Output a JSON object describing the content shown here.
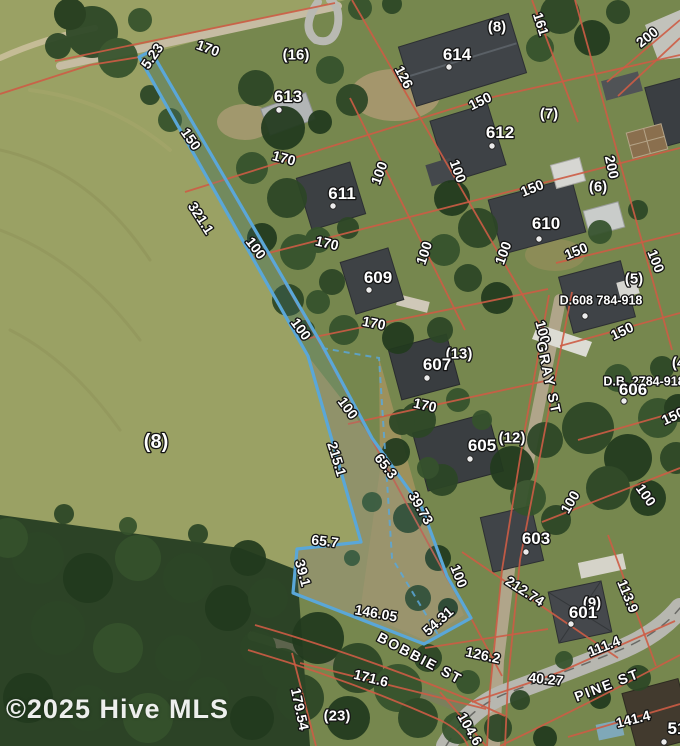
{
  "watermark": "©2025 Hive MLS",
  "colors": {
    "boundary": "#5aa7d8",
    "parcel_lines": "#cd5c45",
    "label_fill": "#ffffff",
    "label_halo": "#141414"
  },
  "map": {
    "type": "aerial-plat-map",
    "streets": [
      "GRAY ST",
      "BOBBIE ST",
      "PINE ST"
    ],
    "parcel_numbers": [
      "601",
      "603",
      "605",
      "606",
      "607",
      "609",
      "610",
      "611",
      "612",
      "613",
      "614"
    ],
    "deed_references": [
      "D.608 784-918",
      "D.B. 2784-918"
    ],
    "subject_boundary_points": "139,57 151,51 322,345 372,438 422,508 447,576 471,618 424,644 293,593 297,549 361,542 308,356",
    "interior_dashed_points": "322,348 379,358 392,558 440,638",
    "house_dots": [
      [
        279,
        110
      ],
      [
        449,
        67
      ],
      [
        492,
        146
      ],
      [
        333,
        206
      ],
      [
        539,
        239
      ],
      [
        369,
        290
      ],
      [
        427,
        378
      ],
      [
        470,
        459
      ],
      [
        526,
        552
      ],
      [
        571,
        624
      ],
      [
        624,
        401
      ],
      [
        585,
        316
      ],
      [
        664,
        742
      ]
    ],
    "labels": [
      {
        "t": "5.23",
        "x": 152,
        "y": 56,
        "r": -55,
        "k": "dim"
      },
      {
        "t": "170",
        "x": 208,
        "y": 48,
        "r": 20,
        "k": "dim"
      },
      {
        "t": "(16)",
        "x": 296,
        "y": 54,
        "r": 0,
        "k": "lot"
      },
      {
        "t": "613",
        "x": 288,
        "y": 96,
        "r": 0,
        "k": "parcel"
      },
      {
        "t": "(8)",
        "x": 497,
        "y": 26,
        "r": 0,
        "k": "lot"
      },
      {
        "t": "161",
        "x": 541,
        "y": 24,
        "r": 72,
        "k": "dim"
      },
      {
        "t": "200",
        "x": 647,
        "y": 37,
        "r": -38,
        "k": "dim"
      },
      {
        "t": "614",
        "x": 457,
        "y": 54,
        "r": 0,
        "k": "parcel"
      },
      {
        "t": "126",
        "x": 404,
        "y": 77,
        "r": 62,
        "k": "dim"
      },
      {
        "t": "150",
        "x": 480,
        "y": 101,
        "r": -26,
        "k": "dim"
      },
      {
        "t": "(7)",
        "x": 549,
        "y": 113,
        "r": 0,
        "k": "lot"
      },
      {
        "t": "612",
        "x": 500,
        "y": 132,
        "r": 0,
        "k": "parcel"
      },
      {
        "t": "150",
        "x": 191,
        "y": 139,
        "r": 55,
        "k": "dim"
      },
      {
        "t": "170",
        "x": 284,
        "y": 158,
        "r": 15,
        "k": "dim"
      },
      {
        "t": "100",
        "x": 379,
        "y": 173,
        "r": -70,
        "k": "dim"
      },
      {
        "t": "100",
        "x": 458,
        "y": 171,
        "r": 70,
        "k": "dim"
      },
      {
        "t": "200",
        "x": 612,
        "y": 167,
        "r": 78,
        "k": "dim"
      },
      {
        "t": "150",
        "x": 532,
        "y": 188,
        "r": -22,
        "k": "dim"
      },
      {
        "t": "(6)",
        "x": 598,
        "y": 186,
        "r": 0,
        "k": "lot"
      },
      {
        "t": "611",
        "x": 342,
        "y": 193,
        "r": 0,
        "k": "parcel"
      },
      {
        "t": "610",
        "x": 546,
        "y": 223,
        "r": 0,
        "k": "parcel"
      },
      {
        "t": "321.1",
        "x": 201,
        "y": 218,
        "r": 57,
        "k": "dim"
      },
      {
        "t": "100",
        "x": 256,
        "y": 248,
        "r": 53,
        "k": "dim"
      },
      {
        "t": "170",
        "x": 327,
        "y": 243,
        "r": 13,
        "k": "dim"
      },
      {
        "t": "100",
        "x": 424,
        "y": 253,
        "r": -72,
        "k": "dim"
      },
      {
        "t": "100",
        "x": 503,
        "y": 253,
        "r": -70,
        "k": "dim"
      },
      {
        "t": "150",
        "x": 576,
        "y": 251,
        "r": -22,
        "k": "dim"
      },
      {
        "t": "100",
        "x": 656,
        "y": 261,
        "r": 68,
        "k": "dim"
      },
      {
        "t": "(5)",
        "x": 634,
        "y": 278,
        "r": 0,
        "k": "lot"
      },
      {
        "t": "609",
        "x": 378,
        "y": 277,
        "r": 0,
        "k": "parcel"
      },
      {
        "t": "D.608 784-918",
        "x": 601,
        "y": 300,
        "r": 0,
        "k": "deed"
      },
      {
        "t": "100",
        "x": 301,
        "y": 329,
        "r": 54,
        "k": "dim"
      },
      {
        "t": "170",
        "x": 374,
        "y": 323,
        "r": 11,
        "k": "dim"
      },
      {
        "t": "100",
        "x": 543,
        "y": 332,
        "r": 75,
        "k": "dim"
      },
      {
        "t": "150",
        "x": 622,
        "y": 331,
        "r": -25,
        "k": "dim"
      },
      {
        "t": "(13)",
        "x": 459,
        "y": 353,
        "r": 0,
        "k": "lot"
      },
      {
        "t": "607",
        "x": 437,
        "y": 364,
        "r": 0,
        "k": "parcel"
      },
      {
        "t": "GRAY ST",
        "x": 549,
        "y": 378,
        "r": 78,
        "k": "street"
      },
      {
        "t": "D.B. 2784-918",
        "x": 644,
        "y": 381,
        "r": 0,
        "k": "deed"
      },
      {
        "t": "606",
        "x": 633,
        "y": 389,
        "r": 0,
        "k": "parcel"
      },
      {
        "t": "(4)",
        "x": 681,
        "y": 362,
        "r": 0,
        "k": "lot"
      },
      {
        "t": "170",
        "x": 425,
        "y": 405,
        "r": 12,
        "k": "dim"
      },
      {
        "t": "100",
        "x": 348,
        "y": 408,
        "r": 54,
        "k": "dim"
      },
      {
        "t": "150",
        "x": 673,
        "y": 416,
        "r": -25,
        "k": "dim"
      },
      {
        "t": "(12)",
        "x": 512,
        "y": 437,
        "r": 0,
        "k": "lot"
      },
      {
        "t": "605",
        "x": 482,
        "y": 445,
        "r": 0,
        "k": "parcel"
      },
      {
        "t": "(8)",
        "x": 156,
        "y": 441,
        "r": 0,
        "k": "lot-large"
      },
      {
        "t": "215.1",
        "x": 337,
        "y": 459,
        "r": 73,
        "k": "dim"
      },
      {
        "t": "65.3",
        "x": 386,
        "y": 466,
        "r": 52,
        "k": "dim"
      },
      {
        "t": "39.73",
        "x": 421,
        "y": 508,
        "r": 60,
        "k": "dim"
      },
      {
        "t": "100",
        "x": 646,
        "y": 495,
        "r": 55,
        "k": "dim"
      },
      {
        "t": "100",
        "x": 570,
        "y": 502,
        "r": -60,
        "k": "dim"
      },
      {
        "t": "603",
        "x": 536,
        "y": 538,
        "r": 0,
        "k": "parcel"
      },
      {
        "t": "65.7",
        "x": 325,
        "y": 541,
        "r": 7,
        "k": "dim"
      },
      {
        "t": "39.1",
        "x": 303,
        "y": 573,
        "r": 75,
        "k": "dim"
      },
      {
        "t": "100",
        "x": 459,
        "y": 576,
        "r": 68,
        "k": "dim"
      },
      {
        "t": "212.74",
        "x": 525,
        "y": 591,
        "r": 33,
        "k": "dim"
      },
      {
        "t": "113.9",
        "x": 628,
        "y": 596,
        "r": 68,
        "k": "dim"
      },
      {
        "t": "(9)",
        "x": 592,
        "y": 602,
        "r": 0,
        "k": "lot"
      },
      {
        "t": "601",
        "x": 583,
        "y": 612,
        "r": 0,
        "k": "parcel"
      },
      {
        "t": "146.05",
        "x": 376,
        "y": 613,
        "r": 10,
        "k": "dim"
      },
      {
        "t": "54.31",
        "x": 438,
        "y": 621,
        "r": -42,
        "k": "dim"
      },
      {
        "t": "111.4",
        "x": 604,
        "y": 646,
        "r": -22,
        "k": "dim"
      },
      {
        "t": "126.2",
        "x": 483,
        "y": 655,
        "r": 12,
        "k": "dim"
      },
      {
        "t": "BOBBIE ST",
        "x": 420,
        "y": 658,
        "r": 28,
        "k": "street"
      },
      {
        "t": "40.27",
        "x": 546,
        "y": 679,
        "r": 6,
        "k": "dim"
      },
      {
        "t": "171.6",
        "x": 371,
        "y": 678,
        "r": 14,
        "k": "dim"
      },
      {
        "t": "PINE ST",
        "x": 607,
        "y": 685,
        "r": -21,
        "k": "street"
      },
      {
        "t": "179.54",
        "x": 300,
        "y": 709,
        "r": 78,
        "k": "dim"
      },
      {
        "t": "(23)",
        "x": 337,
        "y": 715,
        "r": 0,
        "k": "lot"
      },
      {
        "t": "104.6",
        "x": 470,
        "y": 729,
        "r": 60,
        "k": "dim"
      },
      {
        "t": "141.4",
        "x": 633,
        "y": 719,
        "r": -14,
        "k": "dim"
      },
      {
        "t": "51",
        "x": 677,
        "y": 728,
        "r": 0,
        "k": "parcel"
      }
    ]
  }
}
